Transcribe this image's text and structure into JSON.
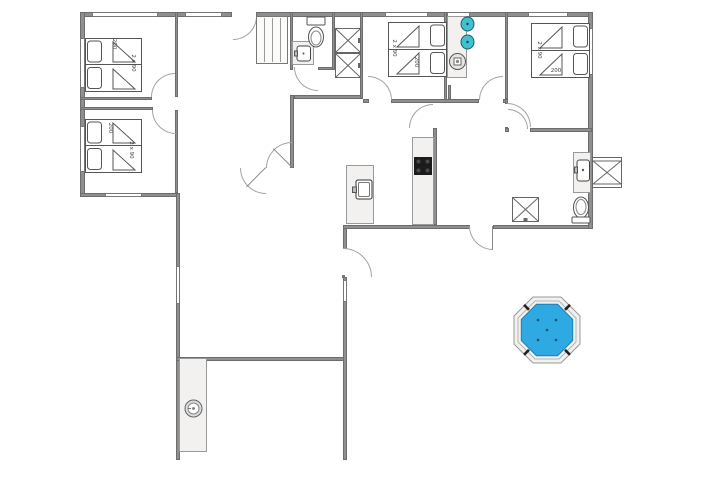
{
  "plan": {
    "bedrooms": [
      {
        "name": "bedroom-top-left",
        "label_length": "200",
        "label_width": "2 x 90"
      },
      {
        "name": "bedroom-bottom-left",
        "label_length": "200",
        "label_width": "2 x 90"
      },
      {
        "name": "bedroom-top-middle",
        "label_length": "200",
        "label_width": "2 x 90"
      },
      {
        "name": "bedroom-top-right",
        "label_length": "200",
        "label_width": "2 x 90"
      }
    ],
    "colors": {
      "wall": "#8f8f8f",
      "wall_edge": "#6d6d6d",
      "counter": "#f2f1ef",
      "hot_tub_water": "#2fa9e1",
      "hot_tub_water_edge": "#1c7fb0",
      "hot_tub_rim": "#f1f1ef",
      "basin_teal": "#43c0cd",
      "cooktop": "#1b1b1b",
      "fixture_line": "#555555",
      "door_arc": "#a3a3a3"
    },
    "icons": [
      "bed",
      "pillow",
      "duvet-fold",
      "wardrobe-x",
      "sliding-wardrobe",
      "toilet",
      "washbasin",
      "washing-machine",
      "kitchen-sink",
      "cooktop",
      "shower-x",
      "outdoor-box-x",
      "hot-tub",
      "round-fixture"
    ]
  }
}
